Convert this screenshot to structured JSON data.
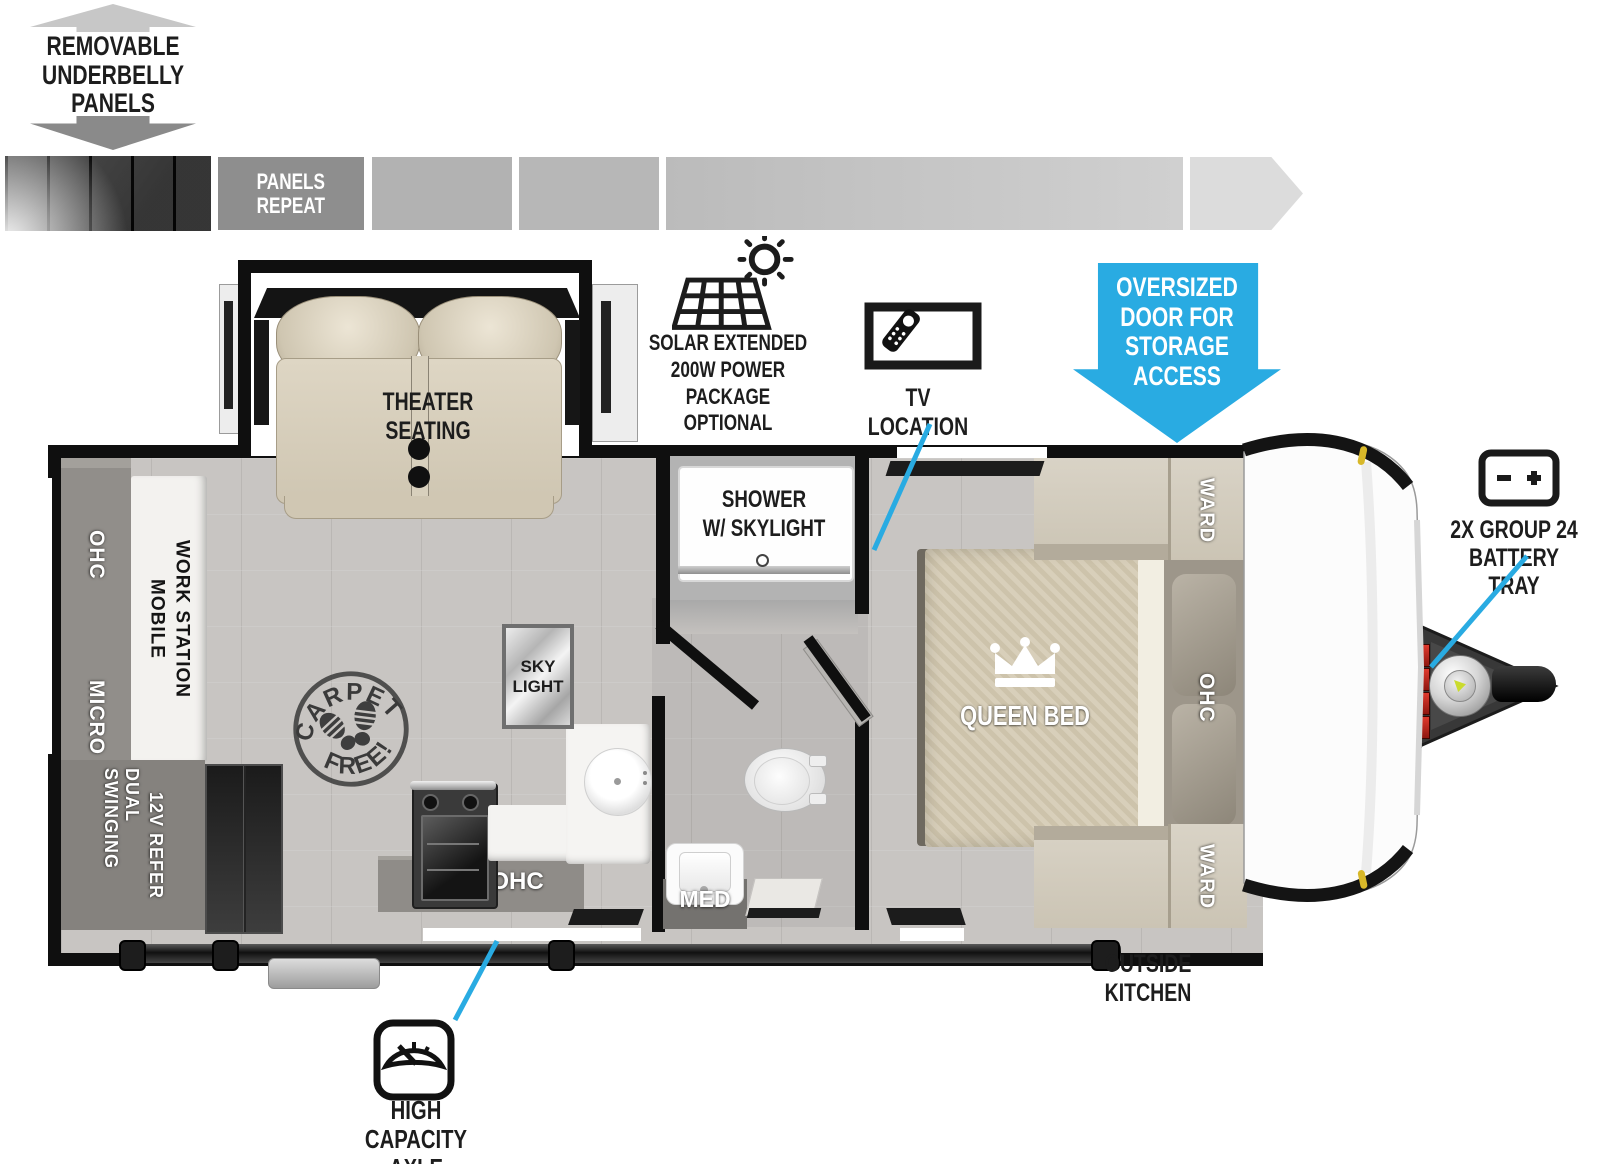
{
  "badge": {
    "underbelly_label": "REMOVABLE\nUNDERBELLY\nPANELS",
    "panels_repeat_label": "PANELS\nREPEAT"
  },
  "callouts": {
    "solar_label": "SOLAR EXTENDED\n200W POWER PACKAGE\nOPTIONAL",
    "tv_label": "TV LOCATION",
    "oversized_door_label": "OVERSIZED\nDOOR FOR\nSTORAGE\nACCESS",
    "battery_label": "2X GROUP 24\nBATTERY TRAY",
    "outside_kitchen_label": "OUTSIDE\nKITCHEN",
    "axle_label": "HIGH CAPACITY\nAXLE",
    "callout_color": "#29abe2"
  },
  "floorplan": {
    "theater_label": "THEATER SEATING",
    "shower_label": "SHOWER\nW/ SKYLIGHT",
    "skylight_label": "SKY\nLIGHT",
    "queen_bed_label": "QUEEN BED",
    "ward_label": "WARD",
    "ohc_label": "OHC",
    "micro_label": "MICRO",
    "med_label": "MED",
    "mobile_work_lines": [
      "MOBILE",
      "WORK STATION"
    ],
    "refer_lines": [
      "DUAL SWINGING",
      "12V REFER"
    ],
    "carpet_stamp": {
      "top": "CARPET",
      "bottom": "FREE!"
    }
  }
}
